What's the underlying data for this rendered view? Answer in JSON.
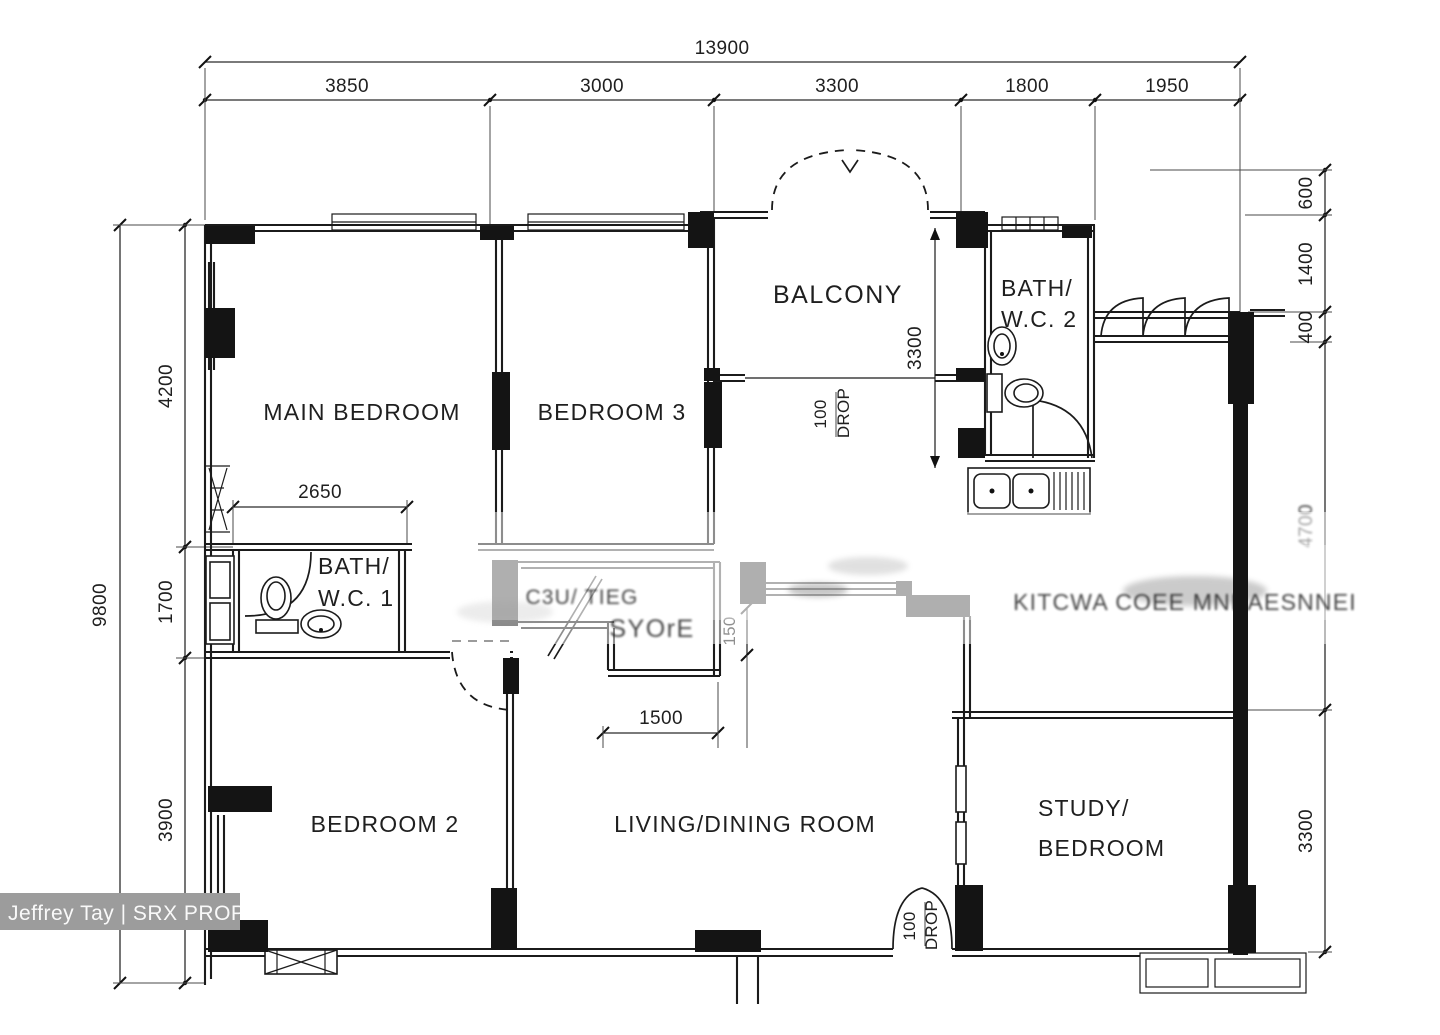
{
  "watermark": {
    "credit": "Jeffrey Tay | SRX PROPERTY"
  },
  "rooms": {
    "main_bedroom": "MAIN BEDROOM",
    "bedroom_3": "BEDROOM 3",
    "balcony": "BALCONY",
    "bath_wc_2": [
      "BATH/",
      "W.C.  2"
    ],
    "bath_wc_1": [
      "BATH/",
      "W.C.  1"
    ],
    "bedroom_2": "BEDROOM 2",
    "living_dining": "LIVING/DINING  ROOM",
    "study_bedroom": [
      "STUDY/",
      "BEDROOM"
    ],
    "kitchen_smudged": "KITCWA COEE MNKAESNNEI",
    "store_smudged": [
      "C3U/ TIEG",
      "SYOrE"
    ]
  },
  "dimensions": {
    "top_total": "13900",
    "top_segments": [
      "3850",
      "3000",
      "3300",
      "1800",
      "1950"
    ],
    "left_total": "9800",
    "left_segments": [
      "4200",
      "1700",
      "3900"
    ],
    "right_segments": [
      "600",
      "1400",
      "400",
      "4700",
      "3300"
    ],
    "bath1_width": "2650",
    "balcony_depth": "3300",
    "store_width": "1500",
    "store_recess": "150",
    "balcony_step": [
      "100",
      "DROP"
    ],
    "entrance_step": [
      "100",
      "DROP"
    ]
  }
}
